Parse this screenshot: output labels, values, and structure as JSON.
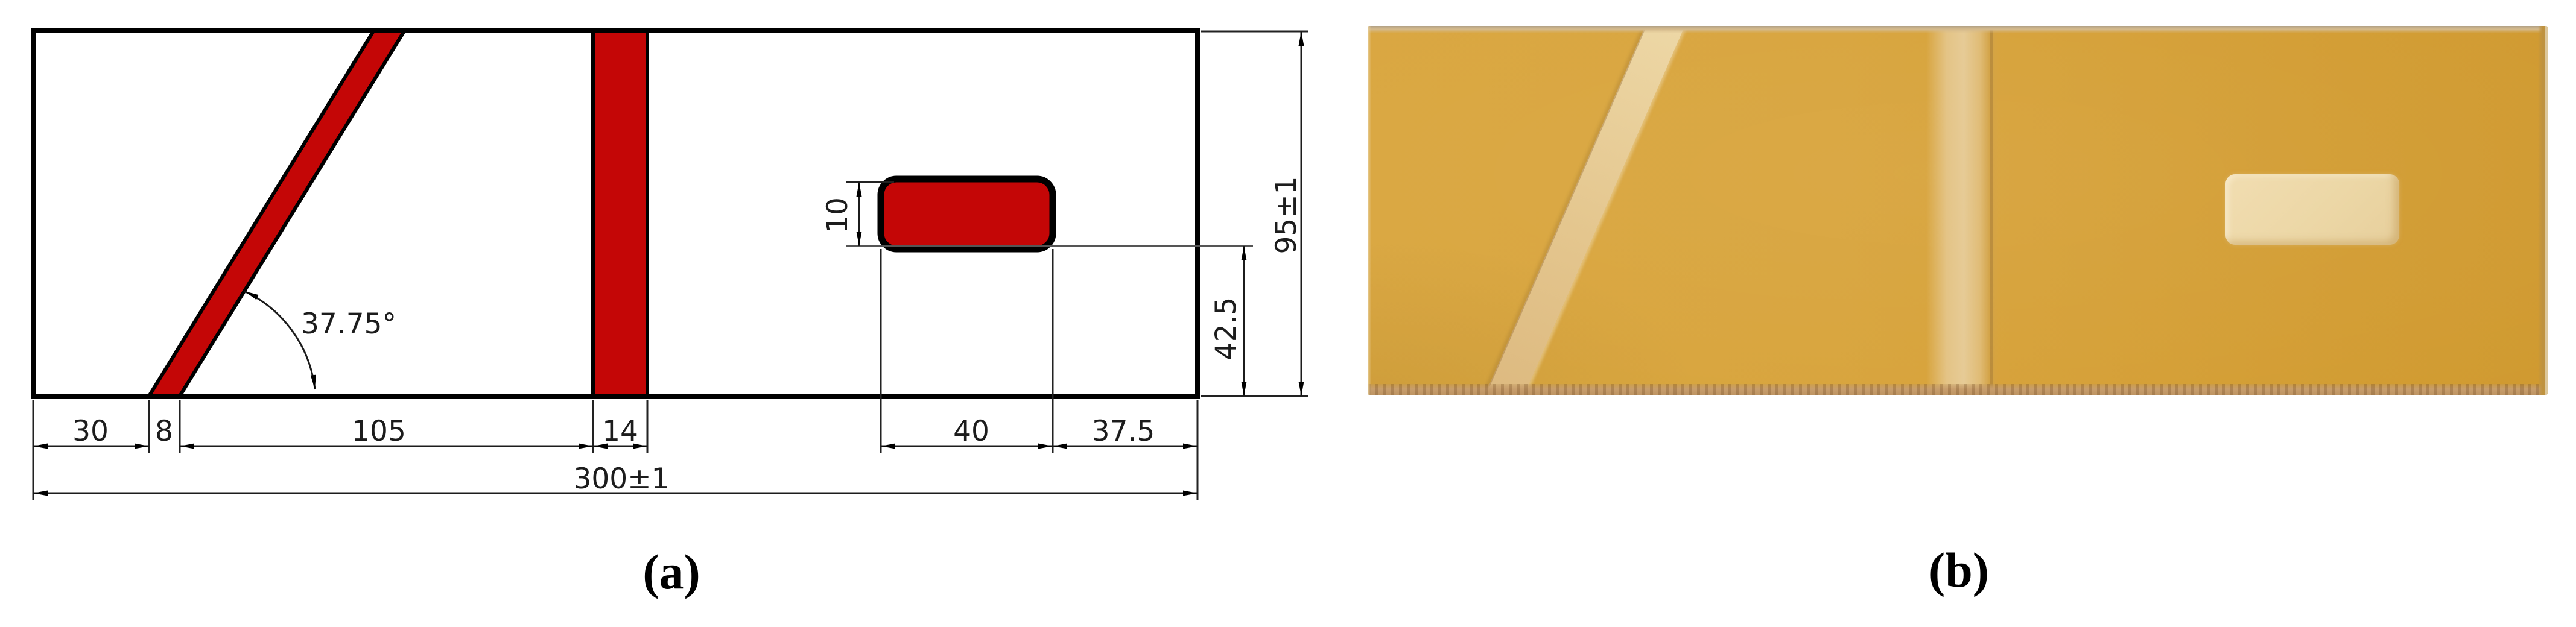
{
  "figure": {
    "panel_a": {
      "label": "(a)",
      "type": "dimensioned technical drawing of specimen with red inserts",
      "angle_label": "37.75°",
      "dims": {
        "offset_left": "30",
        "slanted_width": "8",
        "span_mid": "105",
        "vertical_width": "14",
        "patch_width": "40",
        "patch_offset_right": "37.5",
        "total_width": "300±1",
        "patch_height": "10",
        "patch_offset_bottom": "42.5",
        "total_height": "95±1"
      },
      "colors": {
        "insert_fill": "#c40606",
        "outline": "#000000",
        "dim_line": "#1c1c1c"
      }
    },
    "panel_b": {
      "label": "(b)",
      "type": "photograph of manufactured specimen",
      "colors": {
        "panel": "#d8a43c",
        "insert_strips": "#e6cb96",
        "patch": "#ecd7a6"
      }
    }
  }
}
